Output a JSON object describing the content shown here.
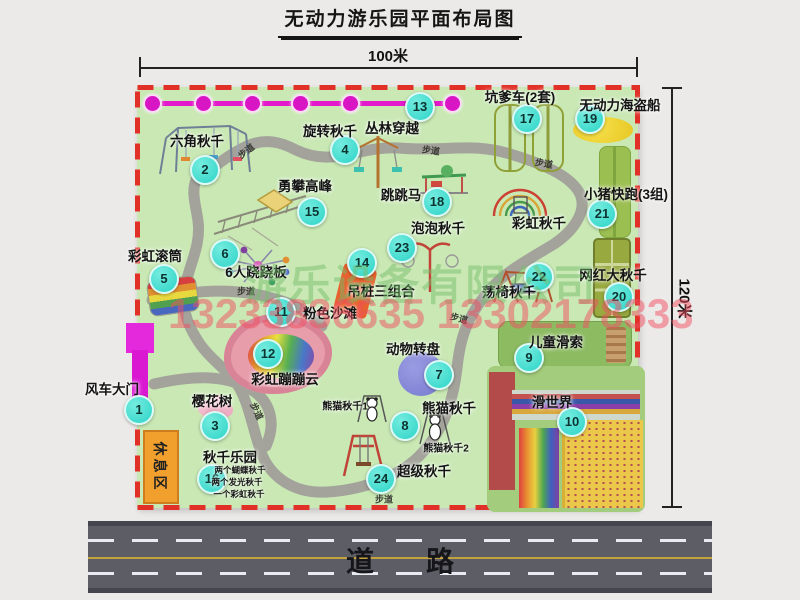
{
  "title": "无动力游乐园平面布局图",
  "dimensions": {
    "width_label": "100米",
    "height_label": "120米"
  },
  "road": {
    "label": "道路"
  },
  "rest_area": {
    "label": "休息区"
  },
  "watermark": {
    "company": "游乐设备有限公司",
    "phone": "13233836635 13302178333"
  },
  "path_label_text": "步道",
  "colors": {
    "park_green": "#c9e8b4",
    "border_red": "#e13028",
    "marker_teal": "#2cd4c7",
    "zipline_magenta": "#e318ca",
    "road_gray": "#5d5d66",
    "rest_orange": "#f1a02e",
    "watermark_green": "#74bc68",
    "watermark_red": "#f24e5f"
  },
  "attractions": [
    {
      "num": "1",
      "name": "风车大门",
      "nx": 137,
      "ny": 408,
      "lx": 112,
      "ly": 388
    },
    {
      "num": "2",
      "name": "六角秋千",
      "nx": 203,
      "ny": 168,
      "lx": 197,
      "ly": 140
    },
    {
      "num": "3",
      "name": "樱花树",
      "nx": 213,
      "ny": 424,
      "lx": 212,
      "ly": 400
    },
    {
      "num": "4",
      "name": "旋转秋千",
      "nx": 343,
      "ny": 148,
      "lx": 330,
      "ly": 130
    },
    {
      "num": "5",
      "name": "彩虹滚筒",
      "nx": 162,
      "ny": 277,
      "lx": 155,
      "ly": 255
    },
    {
      "num": "6",
      "name": "6人跷跷板",
      "nx": 223,
      "ny": 252,
      "lx": 256,
      "ly": 271
    },
    {
      "num": "7",
      "name": "动物转盘",
      "nx": 437,
      "ny": 373,
      "lx": 413,
      "ly": 348
    },
    {
      "num": "8",
      "name": "熊猫秋千",
      "nx": 403,
      "ny": 424,
      "lx": 449,
      "ly": 407
    },
    {
      "num": "9",
      "name": "儿童滑索",
      "nx": 527,
      "ny": 356,
      "lx": 556,
      "ly": 341
    },
    {
      "num": "10",
      "name": "滑世界",
      "nx": 570,
      "ny": 420,
      "lx": 552,
      "ly": 401
    },
    {
      "num": "11",
      "name": "粉色沙滩",
      "nx": 279,
      "ny": 310,
      "lx": 330,
      "ly": 312
    },
    {
      "num": "12",
      "name": "彩虹蹦蹦云",
      "nx": 266,
      "ny": 352,
      "lx": 285,
      "ly": 378
    },
    {
      "num": "13",
      "name": "丛林穿越",
      "nx": 418,
      "ny": 105,
      "lx": 392,
      "ly": 127
    },
    {
      "num": "14",
      "name": "吊桩三组合",
      "nx": 360,
      "ny": 261,
      "lx": 381,
      "ly": 290
    },
    {
      "num": "15",
      "name": "勇攀高峰",
      "nx": 310,
      "ny": 210,
      "lx": 305,
      "ly": 185
    },
    {
      "num": "16",
      "name": "秋千乐园",
      "nx": 210,
      "ny": 477,
      "lx": 230,
      "ly": 456
    },
    {
      "num": "17",
      "name": "坑爹车(2套)",
      "nx": 525,
      "ny": 117,
      "lx": 520,
      "ly": 96
    },
    {
      "num": "18",
      "name": "跳跳马",
      "nx": 435,
      "ny": 200,
      "lx": 401,
      "ly": 194
    },
    {
      "num": "19",
      "name": "无动力海盗船",
      "nx": 588,
      "ny": 117,
      "lx": 620,
      "ly": 104
    },
    {
      "num": "20",
      "name": "网红大秋千",
      "nx": 617,
      "ny": 295,
      "lx": 613,
      "ly": 274
    },
    {
      "num": "21",
      "name": "小猪快跑(3组)",
      "nx": 600,
      "ny": 212,
      "lx": 626,
      "ly": 193
    },
    {
      "num": "22",
      "name": "荡椅秋千",
      "nx": 537,
      "ny": 275,
      "lx": 509,
      "ly": 291
    },
    {
      "num": "23",
      "name": "泡泡秋千",
      "nx": 400,
      "ny": 246,
      "lx": 438,
      "ly": 227
    },
    {
      "num": "24",
      "name": "超级秋千",
      "nx": 379,
      "ny": 477,
      "lx": 424,
      "ly": 470
    }
  ],
  "extra_labels": [
    {
      "text": "彩虹秋千",
      "x": 539,
      "y": 222,
      "cls": "lbl"
    },
    {
      "text": "熊猫秋千1",
      "x": 345,
      "y": 405,
      "cls": "lbl lbl-sm"
    },
    {
      "text": "熊猫秋千2",
      "x": 446,
      "y": 447,
      "cls": "lbl lbl-sm"
    },
    {
      "text": "两个蝴蝶秋千",
      "x": 240,
      "y": 470,
      "cls": "lbl lbl-xs"
    },
    {
      "text": "两个发光秋千",
      "x": 237,
      "y": 482,
      "cls": "lbl lbl-xs"
    },
    {
      "text": "一个彩虹秋千",
      "x": 239,
      "y": 494,
      "cls": "lbl lbl-xs"
    }
  ],
  "path_labels": [
    {
      "x": 246,
      "y": 151,
      "r": -38
    },
    {
      "x": 431,
      "y": 150,
      "r": 8
    },
    {
      "x": 544,
      "y": 163,
      "r": 10
    },
    {
      "x": 246,
      "y": 291,
      "r": 0
    },
    {
      "x": 459,
      "y": 318,
      "r": 15
    },
    {
      "x": 384,
      "y": 499,
      "r": 0
    },
    {
      "x": 257,
      "y": 411,
      "r": 65
    }
  ],
  "zipline": {
    "y": 103,
    "x1": 152,
    "x2": 462,
    "balls_x": [
      152,
      203,
      252,
      300,
      350,
      452
    ]
  }
}
